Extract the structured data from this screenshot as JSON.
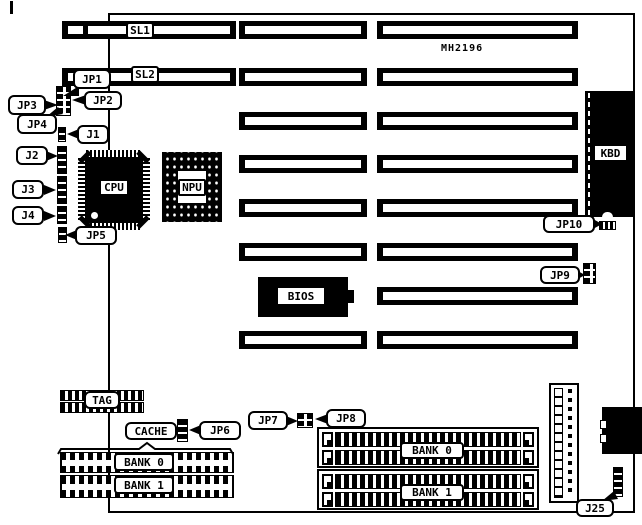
{
  "board": {
    "model": "MH2196"
  },
  "slots": {
    "sl1": "SL1",
    "sl2": "SL2"
  },
  "chips": {
    "cpu": "CPU",
    "npu": "NPU",
    "kbd": "KBD",
    "bios": "BIOS",
    "tag": "TAG",
    "cache": "CACHE"
  },
  "cache_banks": {
    "bank0": "BANK 0",
    "bank1": "BANK 1"
  },
  "simm_banks": {
    "bank0": "BANK 0",
    "bank1": "BANK 1"
  },
  "jumpers": {
    "jp1": "JP1",
    "jp2": "JP2",
    "jp3": "JP3",
    "jp4": "JP4",
    "jp5": "JP5",
    "jp6": "JP6",
    "jp7": "JP7",
    "jp8": "JP8",
    "jp9": "JP9",
    "jp10": "JP10",
    "j1": "J1",
    "j2": "J2",
    "j3": "J3",
    "j4": "J4",
    "j25": "J25"
  },
  "colors": {
    "ink": "#000000",
    "paper": "#ffffff"
  }
}
